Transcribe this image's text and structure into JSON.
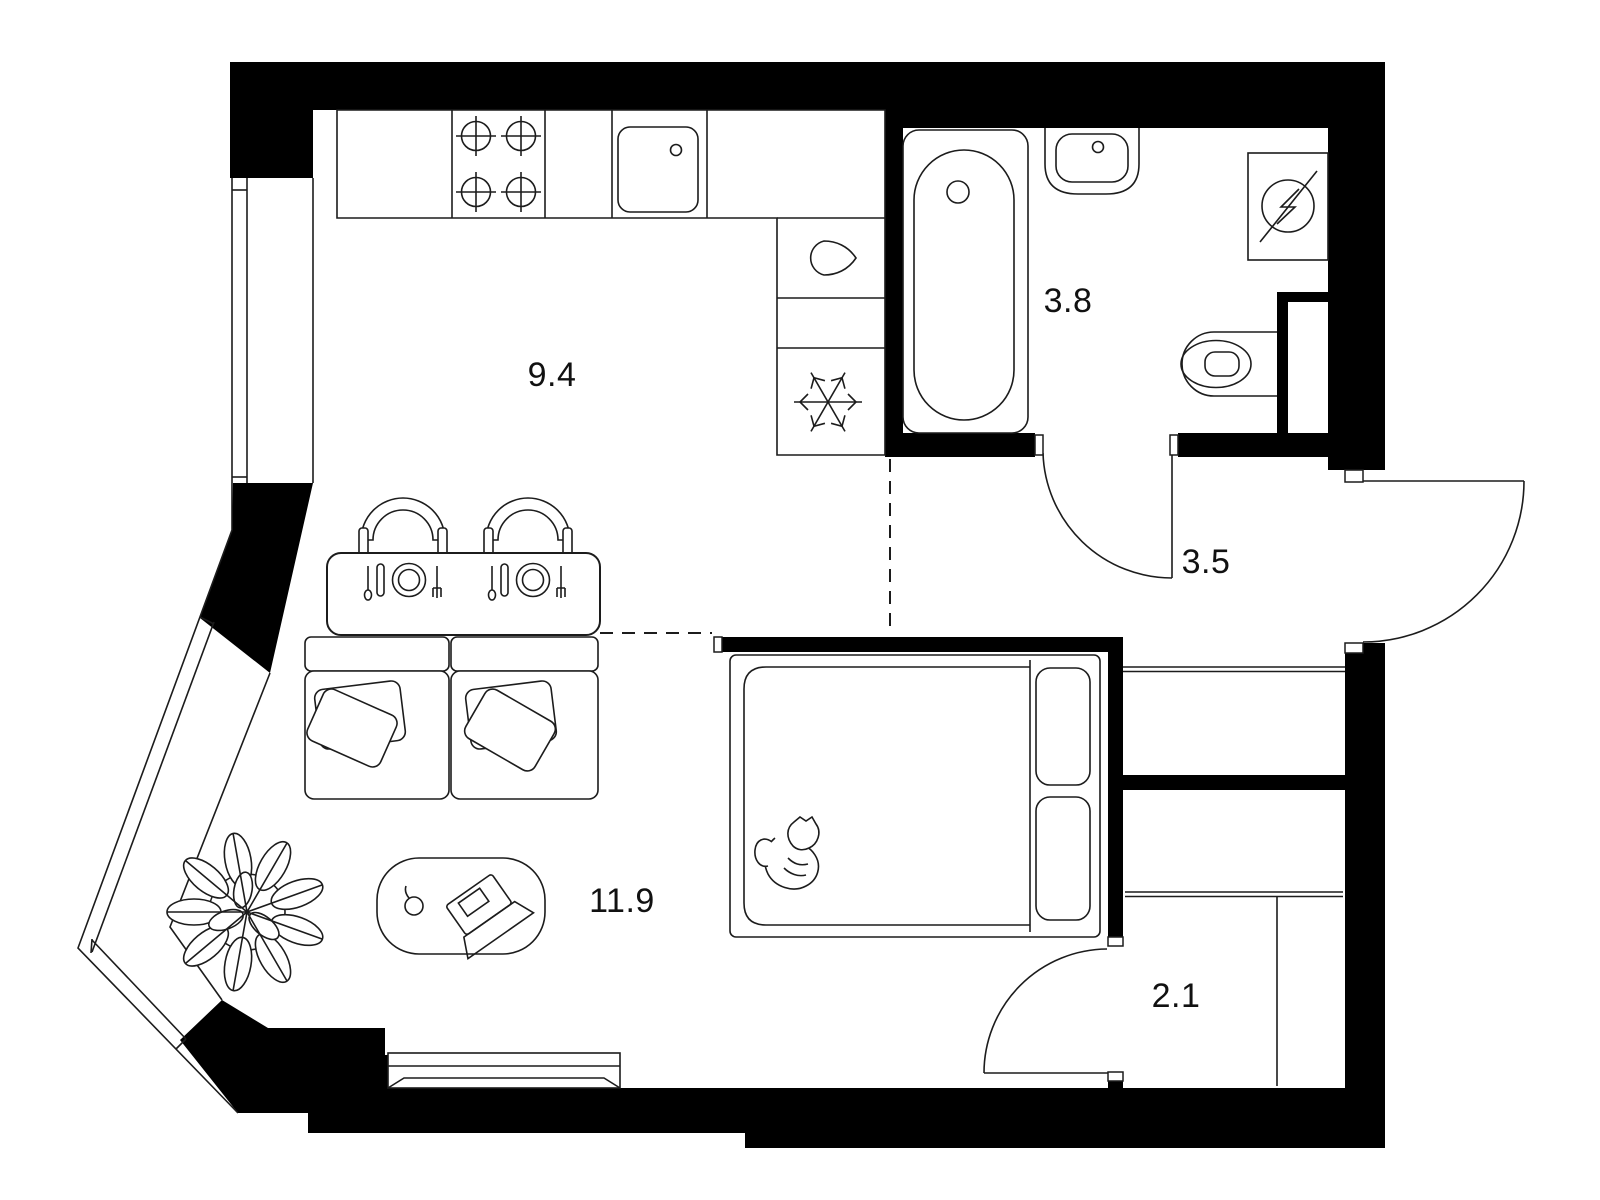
{
  "plan": {
    "type": "apartment-floor-plan",
    "background_color": "#ffffff",
    "wall_color": "#000000",
    "line_color": "#1c1c1c",
    "rooms": [
      {
        "name": "kitchen",
        "area": "9.4"
      },
      {
        "name": "bathroom",
        "area": "3.8"
      },
      {
        "name": "hallway",
        "area": "3.5"
      },
      {
        "name": "living-room",
        "area": "11.9"
      },
      {
        "name": "wardrobe",
        "area": "2.1"
      }
    ],
    "fixtures": [
      "stove-burners-icon",
      "kitchen-sink-icon",
      "kettle-icon",
      "freezer-snowflake-icon",
      "bathtub-icon",
      "washbasin-icon",
      "washing-machine-icon",
      "toilet-icon",
      "ventilation-shaft",
      "dining-table-icon",
      "chair-icon",
      "place-setting-icon",
      "sofa-icon",
      "pillow-icon",
      "double-bed-icon",
      "cat-icon",
      "desk-icon",
      "laptop-icon",
      "mouse-icon",
      "plant-icon",
      "entry-door-arc",
      "bathroom-door-arc",
      "wardrobe-door-arc",
      "window",
      "window-sill"
    ]
  }
}
